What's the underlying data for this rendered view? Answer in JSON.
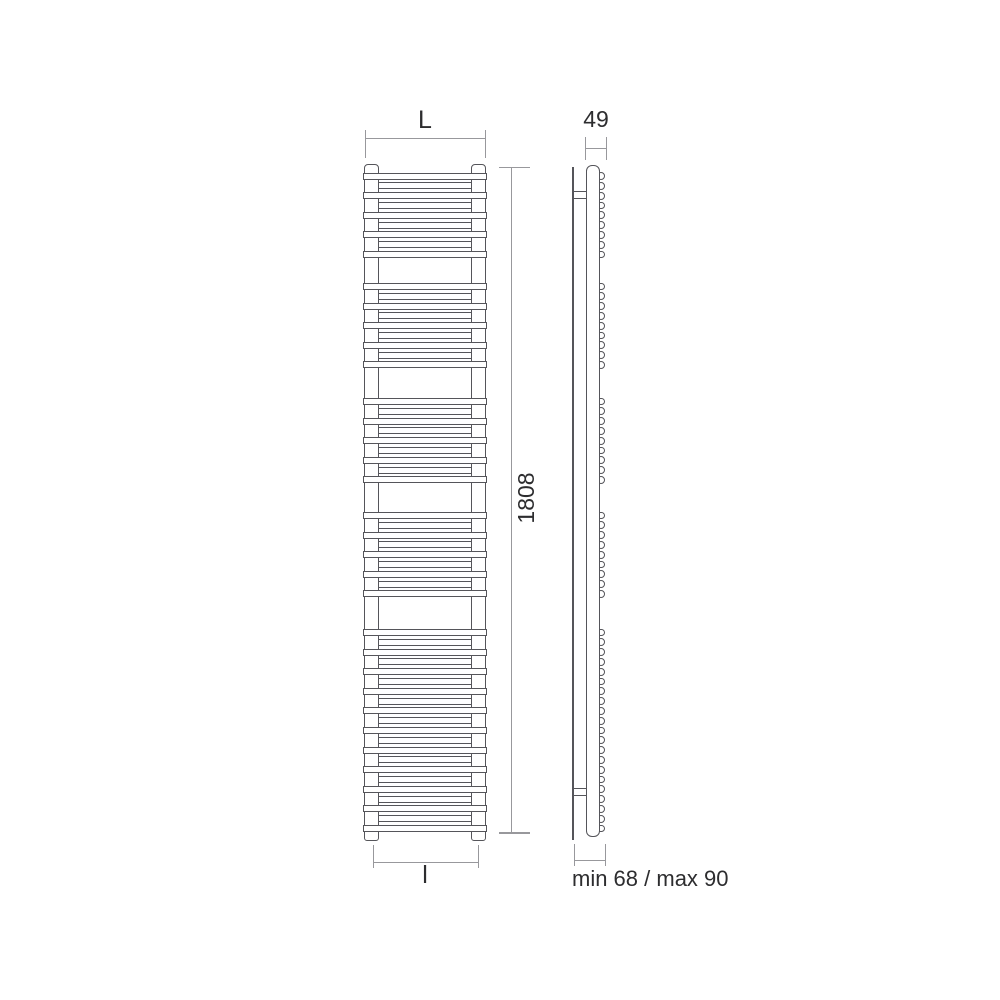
{
  "diagram": {
    "type": "technical-dimension-drawing",
    "subject": "towel-rail-radiator",
    "views": {
      "front": {
        "name": "front-view",
        "sections": [
          {
            "bars": 9
          },
          {
            "bars": 9
          },
          {
            "bars": 9
          },
          {
            "bars": 9
          },
          {
            "bars": 21
          }
        ]
      },
      "side": {
        "name": "side-view",
        "tube_circles_per_section": [
          9,
          9,
          9,
          9,
          21
        ],
        "brackets": 2
      }
    },
    "dimensions": {
      "width_top": "L",
      "width_bottom": "l",
      "height": "1808",
      "depth": "49",
      "wall_distance": "min 68 / max 90"
    },
    "colors": {
      "outline": "#55555a",
      "dimension_line": "#98989c",
      "text": "#2d2d2f",
      "background": "#ffffff"
    }
  }
}
